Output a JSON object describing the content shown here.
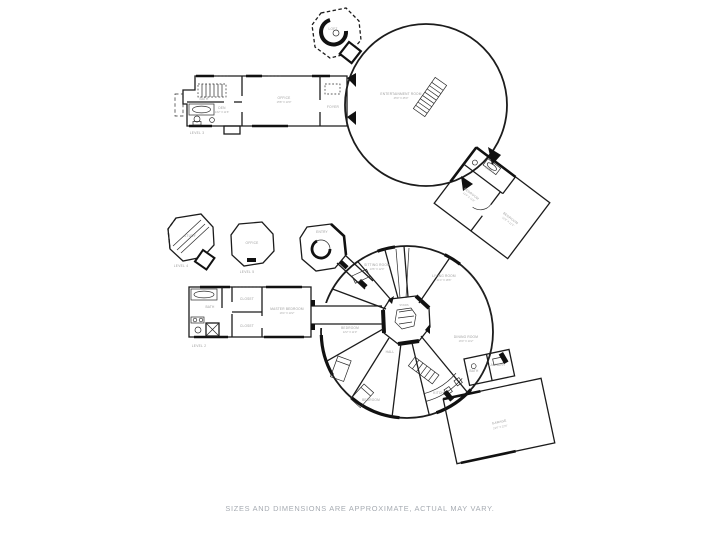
{
  "page": {
    "caption": "SIZES AND DIMENSIONS ARE APPROXIMATE, ACTUAL MAY VARY.",
    "colors": {
      "ink": "#1c1c1c",
      "room_label": "#9a9a9a",
      "caption": "#a6abb2",
      "background": "#ffffff"
    }
  },
  "upper_floor": {
    "level_label": "LEVEL 3",
    "tower": {
      "label": "LOFT"
    },
    "circle_room": {
      "label": "ENTERTAINMENT ROOM",
      "dims": "45'0\" X 45'0\""
    },
    "rooms": [
      {
        "label": "DEN",
        "dims": "14'2\" X 11'6\""
      },
      {
        "label": "OFFICE",
        "dims": "15'8\" X 13'0\""
      },
      {
        "label": "BATH"
      },
      {
        "label": "FOYER"
      },
      {
        "label": "BEDROOM",
        "dims": "13'4\" X 11'8\""
      },
      {
        "label": "BEDROOM",
        "dims": "12'8\" X 11'4\""
      },
      {
        "label": "BATH"
      }
    ]
  },
  "lower_floor": {
    "level_label": "LEVEL 2",
    "towers": [
      {
        "label": "STUDY",
        "level": "LEVEL 4"
      },
      {
        "label": "OFFICE",
        "level": "LEVEL 5"
      },
      {
        "label": "ENTRY"
      }
    ],
    "rooms": [
      {
        "label": "SITTING ROOM",
        "dims": "13'6\" X 12'0\""
      },
      {
        "label": "LIVING ROOM",
        "dims": "21'4\" X 18'6\""
      },
      {
        "label": "DINING ROOM",
        "dims": "16'0\" X 14'2\""
      },
      {
        "label": "KITCHEN"
      },
      {
        "label": "BEDROOM",
        "dims": "12'2\" X 11'0\""
      },
      {
        "label": "BEDROOM"
      },
      {
        "label": "HALL"
      },
      {
        "label": "STAIRS"
      },
      {
        "label": "BATH"
      },
      {
        "label": "CLOSET"
      },
      {
        "label": "CLOSET"
      },
      {
        "label": "MASTER BEDROOM",
        "dims": "16'4\" X 13'2\""
      },
      {
        "label": "GARAGE",
        "dims": "23'0\" X 22'6\""
      },
      {
        "label": "BATH"
      },
      {
        "label": "LAUNDRY"
      }
    ]
  }
}
